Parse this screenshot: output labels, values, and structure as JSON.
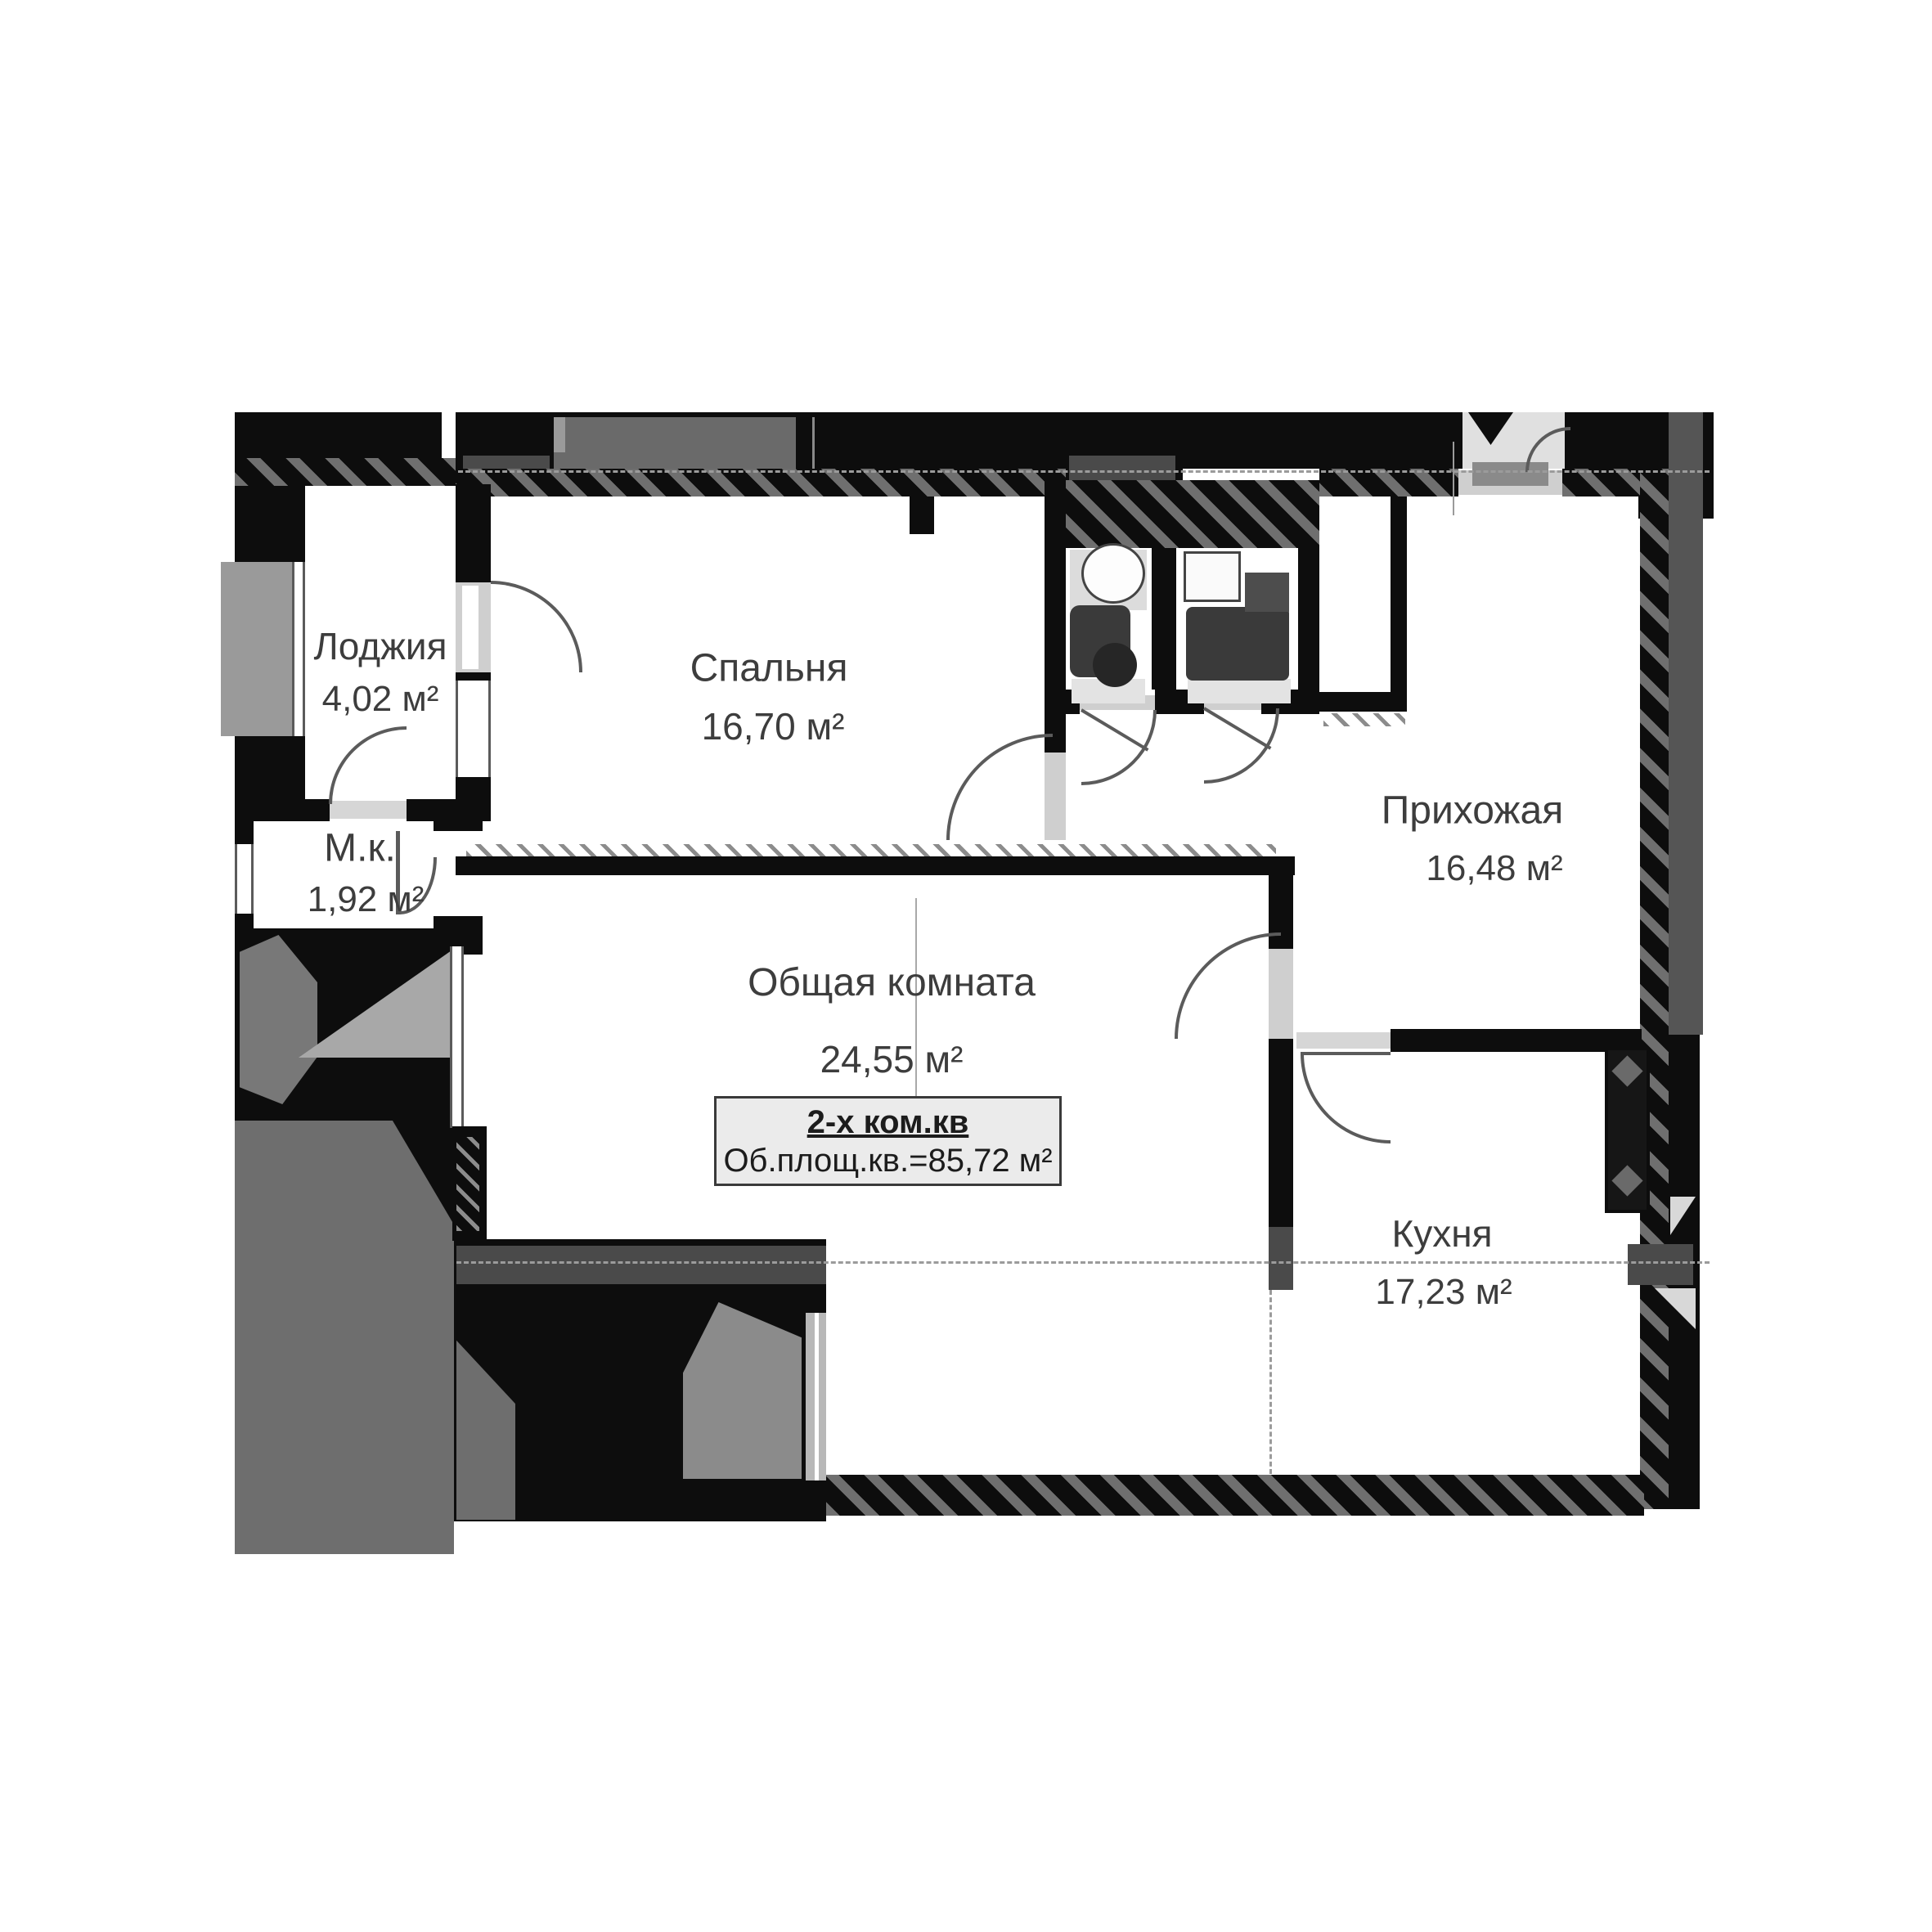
{
  "floor_plan": {
    "rooms": [
      {
        "key": "loggia",
        "name": "Лоджия",
        "area": "4,02 м²"
      },
      {
        "key": "bedroom",
        "name": "Спальня",
        "area": "16,70 м²"
      },
      {
        "key": "small_room",
        "name": "М.к.",
        "area": "1,92 м²"
      },
      {
        "key": "living_room",
        "name": "Общая комната",
        "area": "24,55 м²"
      },
      {
        "key": "hallway",
        "name": "Прихожая",
        "area": "16,48 м²"
      },
      {
        "key": "kitchen",
        "name": "Кухня",
        "area": "17,23 м²"
      }
    ],
    "summary": {
      "apartment_type": "2-х ком.кв",
      "total_area": "Об.площ.кв.=85,72 м²"
    },
    "colors": {
      "wall": "#0d0d0d",
      "wall_hatch": "#6f6f6f",
      "dark_block": "#4a4a4a",
      "exterior_gray": "#6e6e6e",
      "light_gray": "#a8a8a8",
      "threshold": "#cfcfcf",
      "text": "#3d3d3d",
      "info_box_bg": "#ebebeb"
    }
  }
}
